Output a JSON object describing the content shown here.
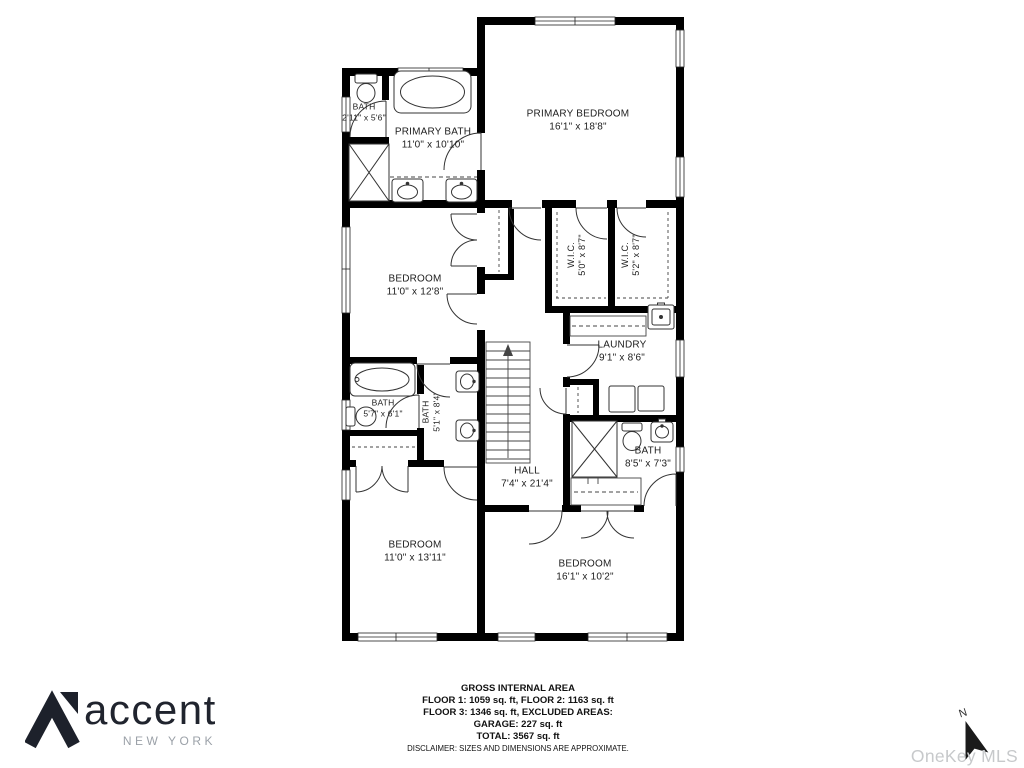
{
  "floorplan": {
    "rooms": [
      {
        "name": "BATH",
        "dims": "2'11\" x 5'6\""
      },
      {
        "name": "PRIMARY BATH",
        "dims": "11'0\" x 10'10\""
      },
      {
        "name": "PRIMARY BEDROOM",
        "dims": "16'1\" x 18'8\""
      },
      {
        "name": "BEDROOM",
        "dims": "11'0\" x 12'8\""
      },
      {
        "name": "W.I.C.",
        "dims": "5'0\" x 8'7\""
      },
      {
        "name": "W.I.C.",
        "dims": "5'2\" x 8'7\""
      },
      {
        "name": "LAUNDRY",
        "dims": "9'1\" x 8'6\""
      },
      {
        "name": "BATH",
        "dims": "5'7\" x 6'1\""
      },
      {
        "name": "BATH",
        "dims": "5'1\" x 8'4\""
      },
      {
        "name": "HALL",
        "dims": "7'4\" x 21'4\""
      },
      {
        "name": "BATH",
        "dims": "8'5\" x 7'3\""
      },
      {
        "name": "BEDROOM",
        "dims": "11'0\" x 13'11\""
      },
      {
        "name": "BEDROOM",
        "dims": "16'1\" x 10'2\""
      }
    ],
    "compass_label": "N",
    "colors": {
      "wall": "#000000",
      "line": "#333333"
    }
  },
  "footer": {
    "title": "GROSS INTERNAL AREA",
    "line1": "FLOOR 1: 1059 sq. ft, FLOOR 2: 1163 sq. ft",
    "line2": "FLOOR 3: 1346 sq. ft, EXCLUDED AREAS:",
    "line3": "GARAGE: 227 sq. ft",
    "line4": "TOTAL: 3567 sq. ft",
    "disclaimer": "DISCLAIMER: SIZES AND DIMENSIONS ARE APPROXIMATE."
  },
  "logo": {
    "name": "accent",
    "subtitle": "NEW YORK",
    "color": "#20242e",
    "subtitle_color": "#9ba1a8"
  },
  "watermark": {
    "text": "OneKey MLS",
    "color": "#c7c9cb"
  }
}
